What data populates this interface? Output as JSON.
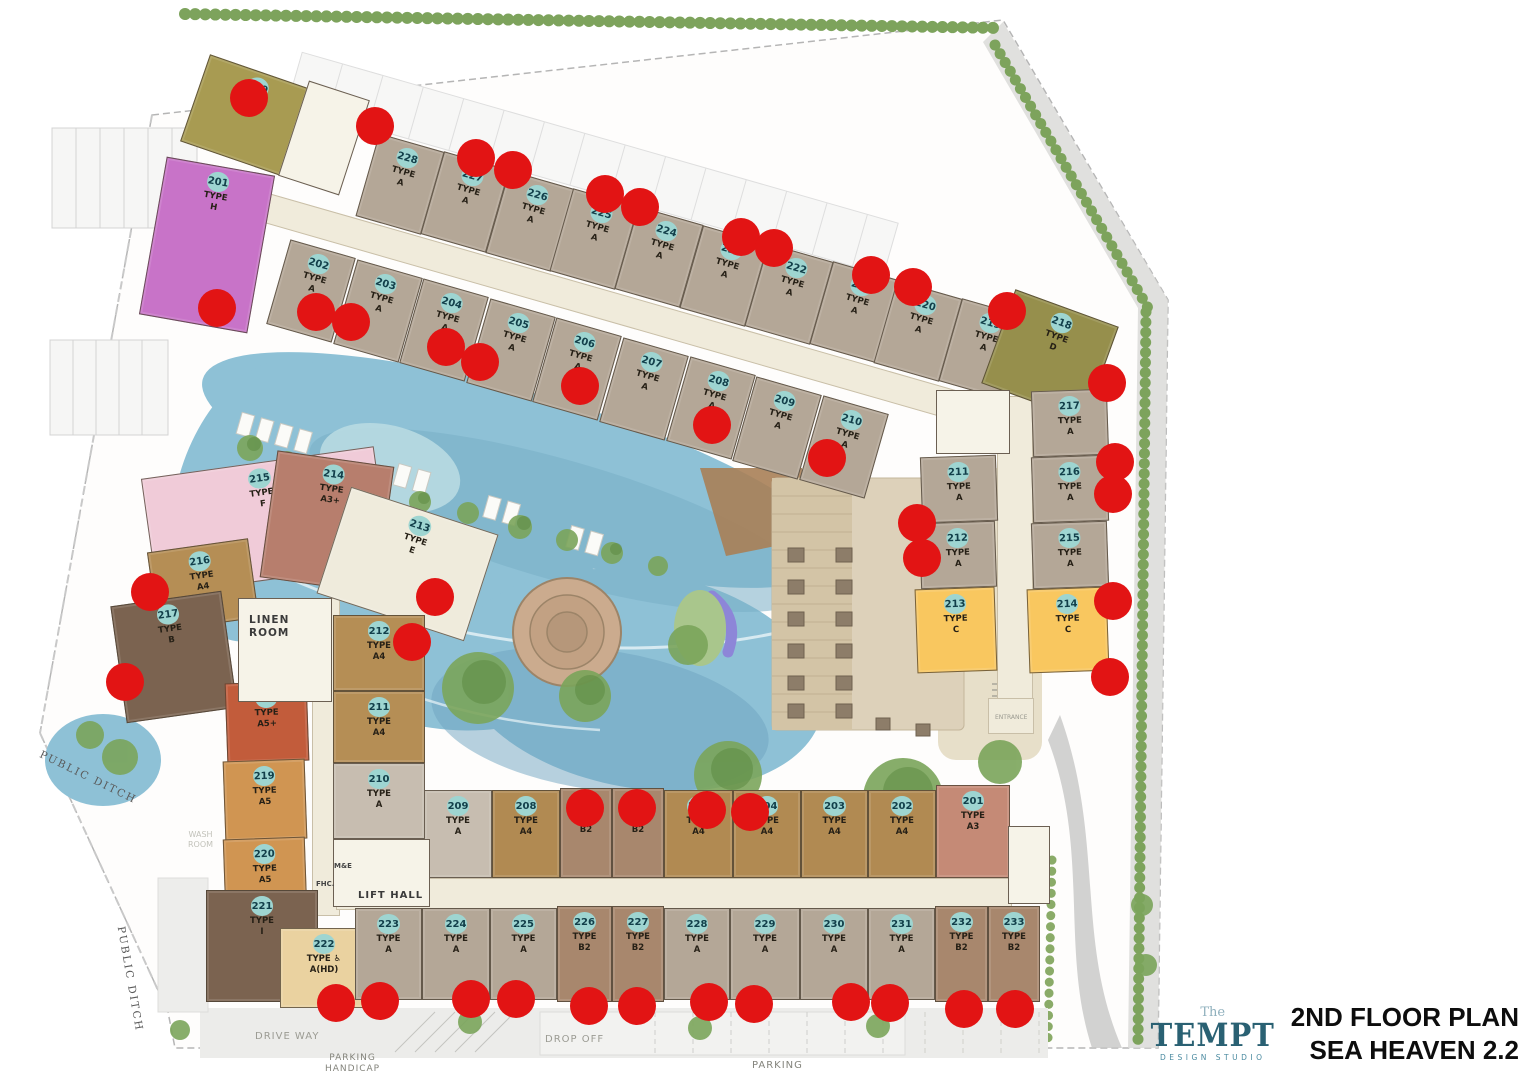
{
  "title": {
    "line1": "2ND FLOOR PLAN",
    "line2": "SEA HEAVEN 2.2"
  },
  "logo": {
    "the": "The",
    "name": "TEMPT",
    "subtitle": "DESIGN STUDIO"
  },
  "colors": {
    "a": "#b4a797",
    "a2": "#c7bdb0",
    "a4": "#b58e55",
    "a4b": "#b18a52",
    "a5": "#d09552",
    "a5p": "#c25c3b",
    "b": "#7b6350",
    "b2": "#a8876d",
    "c": "#f9c75f",
    "d": "#968f4c",
    "e": "#efebdc",
    "f": "#f0cbd8",
    "g": "#a89b52",
    "h": "#c873c8",
    "a3": "#c58a76",
    "a3p": "#b77e6d",
    "ahd": "#ead2a0",
    "i": "#7b6350",
    "corridor": "#f0ebdb",
    "badge": "#9ed5d1",
    "badge_text": "#123f4a",
    "red_dot": "#e21414",
    "pool": "#8ec1d6",
    "hedge": "#7da35c"
  },
  "type_word": "TYPE",
  "units": [
    {
      "n": "228",
      "t": "A",
      "k": "a",
      "x": 366,
      "y": 141,
      "w": 68,
      "h": 86,
      "r": 16
    },
    {
      "n": "227",
      "t": "A",
      "k": "a",
      "x": 431,
      "y": 159,
      "w": 68,
      "h": 86,
      "r": 16
    },
    {
      "n": "226",
      "t": "A",
      "k": "a",
      "x": 496,
      "y": 178,
      "w": 68,
      "h": 86,
      "r": 16
    },
    {
      "n": "225",
      "t": "A",
      "k": "a",
      "x": 560,
      "y": 196,
      "w": 68,
      "h": 86,
      "r": 16
    },
    {
      "n": "224",
      "t": "A",
      "k": "a",
      "x": 625,
      "y": 214,
      "w": 68,
      "h": 86,
      "r": 16
    },
    {
      "n": "223",
      "t": "A",
      "k": "a",
      "x": 690,
      "y": 233,
      "w": 68,
      "h": 86,
      "r": 16
    },
    {
      "n": "222",
      "t": "A",
      "k": "a",
      "x": 755,
      "y": 251,
      "w": 68,
      "h": 86,
      "r": 16
    },
    {
      "n": "221",
      "t": "A",
      "k": "a",
      "x": 820,
      "y": 269,
      "w": 68,
      "h": 86,
      "r": 16
    },
    {
      "n": "220",
      "t": "A",
      "k": "a",
      "x": 884,
      "y": 288,
      "w": 68,
      "h": 86,
      "r": 16
    },
    {
      "n": "219",
      "t": "A",
      "k": "a",
      "x": 949,
      "y": 306,
      "w": 68,
      "h": 86,
      "r": 16
    },
    {
      "n": "202",
      "t": "A",
      "k": "a",
      "x": 277,
      "y": 247,
      "w": 68,
      "h": 88,
      "r": 16
    },
    {
      "n": "203",
      "t": "A",
      "k": "a",
      "x": 344,
      "y": 267,
      "w": 68,
      "h": 88,
      "r": 16
    },
    {
      "n": "204",
      "t": "A",
      "k": "a",
      "x": 410,
      "y": 286,
      "w": 68,
      "h": 88,
      "r": 16
    },
    {
      "n": "205",
      "t": "A",
      "k": "a",
      "x": 477,
      "y": 306,
      "w": 68,
      "h": 88,
      "r": 16
    },
    {
      "n": "206",
      "t": "A",
      "k": "a",
      "x": 543,
      "y": 325,
      "w": 68,
      "h": 88,
      "r": 16
    },
    {
      "n": "207",
      "t": "A",
      "k": "a",
      "x": 610,
      "y": 345,
      "w": 68,
      "h": 88,
      "r": 16
    },
    {
      "n": "208",
      "t": "A",
      "k": "a",
      "x": 677,
      "y": 364,
      "w": 68,
      "h": 88,
      "r": 16
    },
    {
      "n": "209",
      "t": "A",
      "k": "a",
      "x": 743,
      "y": 384,
      "w": 68,
      "h": 88,
      "r": 16
    },
    {
      "n": "210",
      "t": "A",
      "k": "a",
      "x": 810,
      "y": 403,
      "w": 68,
      "h": 88,
      "r": 16
    },
    {
      "n": "229",
      "t": "G",
      "k": "g",
      "x": 192,
      "y": 70,
      "w": 112,
      "h": 92,
      "r": 19
    },
    {
      "n": "201",
      "t": "H",
      "k": "h",
      "x": 152,
      "y": 165,
      "w": 110,
      "h": 160,
      "r": 10
    },
    {
      "n": "218",
      "t": "D",
      "k": "d",
      "x": 995,
      "y": 305,
      "w": 110,
      "h": 100,
      "r": 20
    },
    {
      "n": "217",
      "t": "A",
      "k": "a",
      "x": 1032,
      "y": 390,
      "w": 76,
      "h": 66,
      "r": -2
    },
    {
      "n": "216",
      "t": "A",
      "k": "a",
      "x": 1032,
      "y": 456,
      "w": 76,
      "h": 66,
      "r": -2
    },
    {
      "n": "215",
      "t": "A",
      "k": "a",
      "x": 1032,
      "y": 522,
      "w": 76,
      "h": 66,
      "r": -2
    },
    {
      "n": "211",
      "t": "A",
      "k": "a",
      "x": 921,
      "y": 456,
      "w": 76,
      "h": 66,
      "r": -2
    },
    {
      "n": "212",
      "t": "A",
      "k": "a",
      "x": 920,
      "y": 522,
      "w": 76,
      "h": 66,
      "r": -2
    },
    {
      "n": "213",
      "t": "C",
      "k": "c",
      "x": 916,
      "y": 588,
      "w": 80,
      "h": 84,
      "r": -2
    },
    {
      "n": "214",
      "t": "C",
      "k": "c",
      "x": 1028,
      "y": 588,
      "w": 80,
      "h": 84,
      "r": -2
    },
    {
      "n": "215",
      "t": "F",
      "k": "f",
      "x": 148,
      "y": 462,
      "w": 235,
      "h": 118,
      "r": -8
    },
    {
      "n": "214",
      "t": "A3+",
      "k": "a3p",
      "x": 268,
      "y": 458,
      "w": 118,
      "h": 128,
      "r": 8
    },
    {
      "n": "213",
      "t": "E",
      "k": "e",
      "x": 330,
      "y": 508,
      "w": 155,
      "h": 112,
      "r": 18
    },
    {
      "n": "216",
      "t": "A4",
      "k": "a4",
      "x": 152,
      "y": 545,
      "w": 102,
      "h": 80,
      "r": -8
    },
    {
      "n": "217",
      "t": "B",
      "k": "b",
      "x": 118,
      "y": 598,
      "w": 112,
      "h": 118,
      "r": -8
    },
    {
      "n": "218",
      "t": "A5+",
      "k": "a5p",
      "x": 226,
      "y": 682,
      "w": 82,
      "h": 80,
      "r": -2
    },
    {
      "n": "219",
      "t": "A5",
      "k": "a5",
      "x": 224,
      "y": 760,
      "w": 82,
      "h": 80,
      "r": -2
    },
    {
      "n": "220",
      "t": "A5",
      "k": "a5",
      "x": 224,
      "y": 838,
      "w": 82,
      "h": 72,
      "r": -2
    },
    {
      "n": "221",
      "t": "I",
      "k": "i",
      "x": 206,
      "y": 890,
      "w": 112,
      "h": 112,
      "r": 0
    },
    {
      "n": "222",
      "t": "A(HD)",
      "k": "ahd",
      "hd": true,
      "x": 280,
      "y": 928,
      "w": 88,
      "h": 80,
      "r": 0
    },
    {
      "n": "212",
      "t": "A4",
      "k": "a4",
      "x": 333,
      "y": 615,
      "w": 92,
      "h": 76,
      "r": 0
    },
    {
      "n": "211",
      "t": "A4",
      "k": "a4",
      "x": 333,
      "y": 691,
      "w": 92,
      "h": 72,
      "r": 0
    },
    {
      "n": "210",
      "t": "A",
      "k": "a2",
      "x": 333,
      "y": 763,
      "w": 92,
      "h": 76,
      "r": 0
    },
    {
      "n": "209",
      "t": "A",
      "k": "a2",
      "x": 424,
      "y": 790,
      "w": 68,
      "h": 88,
      "r": 0
    },
    {
      "n": "208",
      "t": "A4",
      "k": "a4b",
      "x": 492,
      "y": 790,
      "w": 68,
      "h": 88,
      "r": 0
    },
    {
      "n": "207",
      "t": "B2",
      "k": "b2",
      "x": 560,
      "y": 788,
      "w": 52,
      "h": 90,
      "r": 0
    },
    {
      "n": "206",
      "t": "B2",
      "k": "b2",
      "x": 612,
      "y": 788,
      "w": 52,
      "h": 90,
      "r": 0
    },
    {
      "n": "205",
      "t": "A4",
      "k": "a4b",
      "x": 664,
      "y": 790,
      "w": 69,
      "h": 88,
      "r": 0
    },
    {
      "n": "204",
      "t": "A4",
      "k": "a4b",
      "x": 733,
      "y": 790,
      "w": 68,
      "h": 88,
      "r": 0
    },
    {
      "n": "203",
      "t": "A4",
      "k": "a4b",
      "x": 801,
      "y": 790,
      "w": 67,
      "h": 88,
      "r": 0
    },
    {
      "n": "202",
      "t": "A4",
      "k": "a4b",
      "x": 868,
      "y": 790,
      "w": 68,
      "h": 88,
      "r": 0
    },
    {
      "n": "201",
      "t": "A3",
      "k": "a3",
      "x": 936,
      "y": 785,
      "w": 74,
      "h": 93,
      "r": 0
    },
    {
      "n": "223",
      "t": "A",
      "k": "a",
      "x": 355,
      "y": 908,
      "w": 67,
      "h": 92,
      "r": 0
    },
    {
      "n": "224",
      "t": "A",
      "k": "a",
      "x": 422,
      "y": 908,
      "w": 68,
      "h": 92,
      "r": 0
    },
    {
      "n": "225",
      "t": "A",
      "k": "a",
      "x": 490,
      "y": 908,
      "w": 67,
      "h": 92,
      "r": 0
    },
    {
      "n": "226",
      "t": "B2",
      "k": "b2",
      "x": 557,
      "y": 906,
      "w": 55,
      "h": 96,
      "r": 0
    },
    {
      "n": "227",
      "t": "B2",
      "k": "b2",
      "x": 612,
      "y": 906,
      "w": 52,
      "h": 96,
      "r": 0
    },
    {
      "n": "228",
      "t": "A",
      "k": "a",
      "x": 664,
      "y": 908,
      "w": 66,
      "h": 92,
      "r": 0
    },
    {
      "n": "229",
      "t": "A",
      "k": "a",
      "x": 730,
      "y": 908,
      "w": 70,
      "h": 92,
      "r": 0
    },
    {
      "n": "230",
      "t": "A",
      "k": "a",
      "x": 800,
      "y": 908,
      "w": 68,
      "h": 92,
      "r": 0
    },
    {
      "n": "231",
      "t": "A",
      "k": "a",
      "x": 868,
      "y": 908,
      "w": 67,
      "h": 92,
      "r": 0
    },
    {
      "n": "232",
      "t": "B2",
      "k": "b2",
      "x": 935,
      "y": 906,
      "w": 53,
      "h": 96,
      "r": 0
    },
    {
      "n": "233",
      "t": "B2",
      "k": "b2",
      "x": 988,
      "y": 906,
      "w": 52,
      "h": 96,
      "r": 0
    }
  ],
  "facility_labels": [
    {
      "id": "linen-room",
      "text": "LINEN\nROOM",
      "x": 249,
      "y": 614,
      "size": 10.5,
      "color": "#3a3a3a",
      "weight": "bold",
      "ls": 1
    },
    {
      "id": "lift-hall",
      "text": "LIFT HALL",
      "x": 358,
      "y": 890,
      "size": 10,
      "color": "#3a3a3a",
      "weight": "bold",
      "ls": 1
    },
    {
      "id": "m-e",
      "text": "M&E",
      "x": 334,
      "y": 862,
      "size": 7,
      "color": "#444",
      "weight": "bold"
    },
    {
      "id": "fhc",
      "text": "FHC.",
      "x": 316,
      "y": 880,
      "size": 7,
      "color": "#444",
      "weight": "bold"
    },
    {
      "id": "entrance",
      "text": "ENTRANCE",
      "x": 995,
      "y": 714,
      "size": 6,
      "color": "#9a9a90"
    },
    {
      "id": "wash-room",
      "text": "WASH\nROOM",
      "x": 188,
      "y": 830,
      "size": 8,
      "color": "#c2c2ba"
    }
  ],
  "site_labels": [
    {
      "id": "public-ditch-1",
      "text": "PUBLIC DITCH",
      "x": 40,
      "y": 748,
      "size": 10.5,
      "color": "#5a5a5a",
      "rot": 26,
      "ls": 2,
      "serif": true
    },
    {
      "id": "public-ditch-2",
      "text": "PUBLIC DITCH",
      "x": 120,
      "y": 920,
      "size": 10.5,
      "color": "#5a5a5a",
      "rot": 80,
      "ls": 2,
      "serif": true
    },
    {
      "id": "drive-way",
      "text": "DRIVE WAY",
      "x": 255,
      "y": 1031,
      "size": 10,
      "color": "#9b9b93",
      "ls": 1
    },
    {
      "id": "drop-off",
      "text": "DROP OFF",
      "x": 545,
      "y": 1034,
      "size": 10,
      "color": "#9b9b93",
      "ls": 1
    },
    {
      "id": "parking-handicap",
      "text": "PARKING\nHANDICAP",
      "x": 325,
      "y": 1053,
      "size": 9,
      "color": "#84847c",
      "ls": 1
    },
    {
      "id": "parking",
      "text": "PARKING",
      "x": 752,
      "y": 1060,
      "size": 10,
      "color": "#84847c",
      "ls": 1
    }
  ],
  "red_dots": [
    [
      249,
      98
    ],
    [
      375,
      126
    ],
    [
      476,
      158
    ],
    [
      513,
      170
    ],
    [
      605,
      194
    ],
    [
      640,
      207
    ],
    [
      741,
      237
    ],
    [
      774,
      248
    ],
    [
      871,
      275
    ],
    [
      913,
      287
    ],
    [
      1007,
      311
    ],
    [
      217,
      308
    ],
    [
      316,
      312
    ],
    [
      351,
      322
    ],
    [
      446,
      347
    ],
    [
      480,
      362
    ],
    [
      580,
      386
    ],
    [
      712,
      425
    ],
    [
      827,
      458
    ],
    [
      1107,
      383
    ],
    [
      1115,
      462
    ],
    [
      1113,
      494
    ],
    [
      917,
      523
    ],
    [
      922,
      558
    ],
    [
      1113,
      601
    ],
    [
      1110,
      677
    ],
    [
      150,
      592
    ],
    [
      435,
      597
    ],
    [
      412,
      642
    ],
    [
      125,
      682
    ],
    [
      585,
      808
    ],
    [
      637,
      808
    ],
    [
      707,
      810
    ],
    [
      750,
      812
    ],
    [
      336,
      1003
    ],
    [
      380,
      1001
    ],
    [
      471,
      999
    ],
    [
      516,
      999
    ],
    [
      589,
      1006
    ],
    [
      637,
      1006
    ],
    [
      709,
      1002
    ],
    [
      754,
      1004
    ],
    [
      851,
      1002
    ],
    [
      890,
      1003
    ],
    [
      964,
      1009
    ],
    [
      1015,
      1009
    ]
  ]
}
